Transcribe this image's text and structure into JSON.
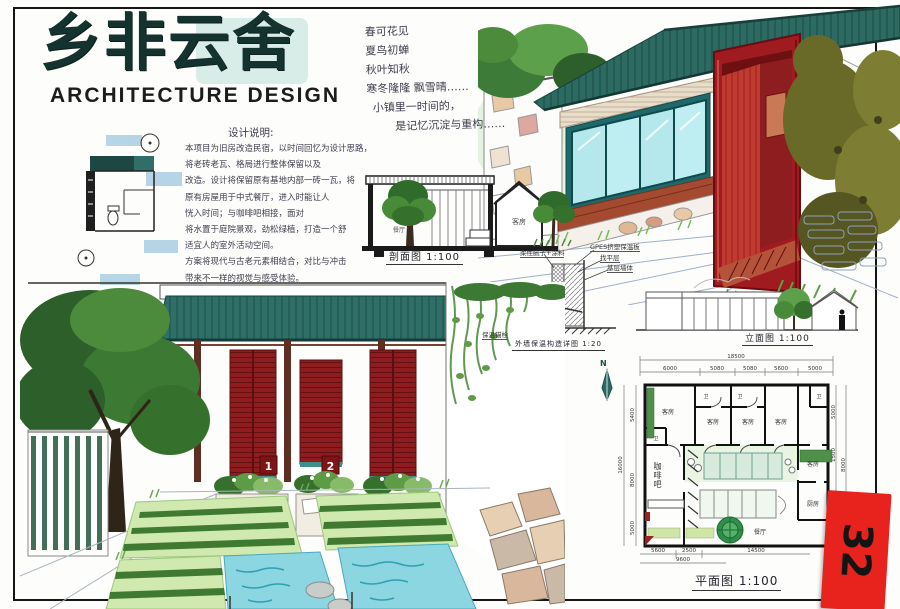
{
  "sheet": {
    "title": "乡非云舍",
    "subtitle": "ARCHITECTURE DESIGN",
    "tab_number": "32",
    "tab_color": "#e8231d"
  },
  "poem": {
    "lines": [
      "春可花见",
      "夏鸟初蝉",
      "秋叶知秋",
      "寒冬隆隆 飘雪晴……",
      "小镇里一时间的，",
      "是记忆沉淀与重构……"
    ]
  },
  "notes": {
    "heading": "设计说明:",
    "lines": [
      "本项目为旧房改造民宿，以时间回忆为设计思路，",
      "将老砖老瓦、格局进行整体保留以及",
      "改造。设计将保留原有基地内部一砖一瓦，将",
      "原有房屋用于中式餐厅，进入时能让人",
      "恍入时间；与咖啡吧相接，面对",
      "将水置于庭院景观，劲松绿植，打造一个舒",
      "适宜人的室外活动空间。",
      "方案将现代与古老元素相结合，对比与冲击",
      "带来不一样的视觉与感受体验。"
    ]
  },
  "drawings": {
    "section": {
      "caption": "剖面图 1:100",
      "rooms": {
        "dining": "餐厅",
        "guest": "客房"
      }
    },
    "detail": {
      "caption": "外墙保温构造详图 1:20",
      "labels": {
        "putty": "柔性腻子+涂料",
        "board": "GPES挤塑保温板",
        "leveling": "找平层",
        "base_wall": "基层墙体",
        "anchor": "保温锚栓"
      }
    },
    "elevation": {
      "caption": "立面图 1:100"
    },
    "plan": {
      "caption": "平面图 1:100",
      "north": "N",
      "rooms": {
        "guest": "客房",
        "coffee": "咖啡吧",
        "dining": "餐厅",
        "kitchen": "厨房",
        "wc": "卫"
      },
      "dims": {
        "top_total": "18500",
        "top": [
          "6000",
          "5080",
          "5080",
          "5600",
          "5000"
        ],
        "left": [
          "5400",
          "8000",
          "5000",
          "16000"
        ],
        "right": [
          "5000",
          "1500",
          "4800",
          "8000"
        ],
        "bottom": [
          "5600",
          "2500",
          "14500"
        ],
        "bottom_total": "9600"
      }
    },
    "courtyard": {
      "door_numbers": [
        "1",
        "2"
      ]
    }
  },
  "colors": {
    "roof_teal": "#2f6f68",
    "door_red": "#a01b20",
    "water_blue": "#8bd6e0",
    "plant_green": "#4e8f4a"
  }
}
